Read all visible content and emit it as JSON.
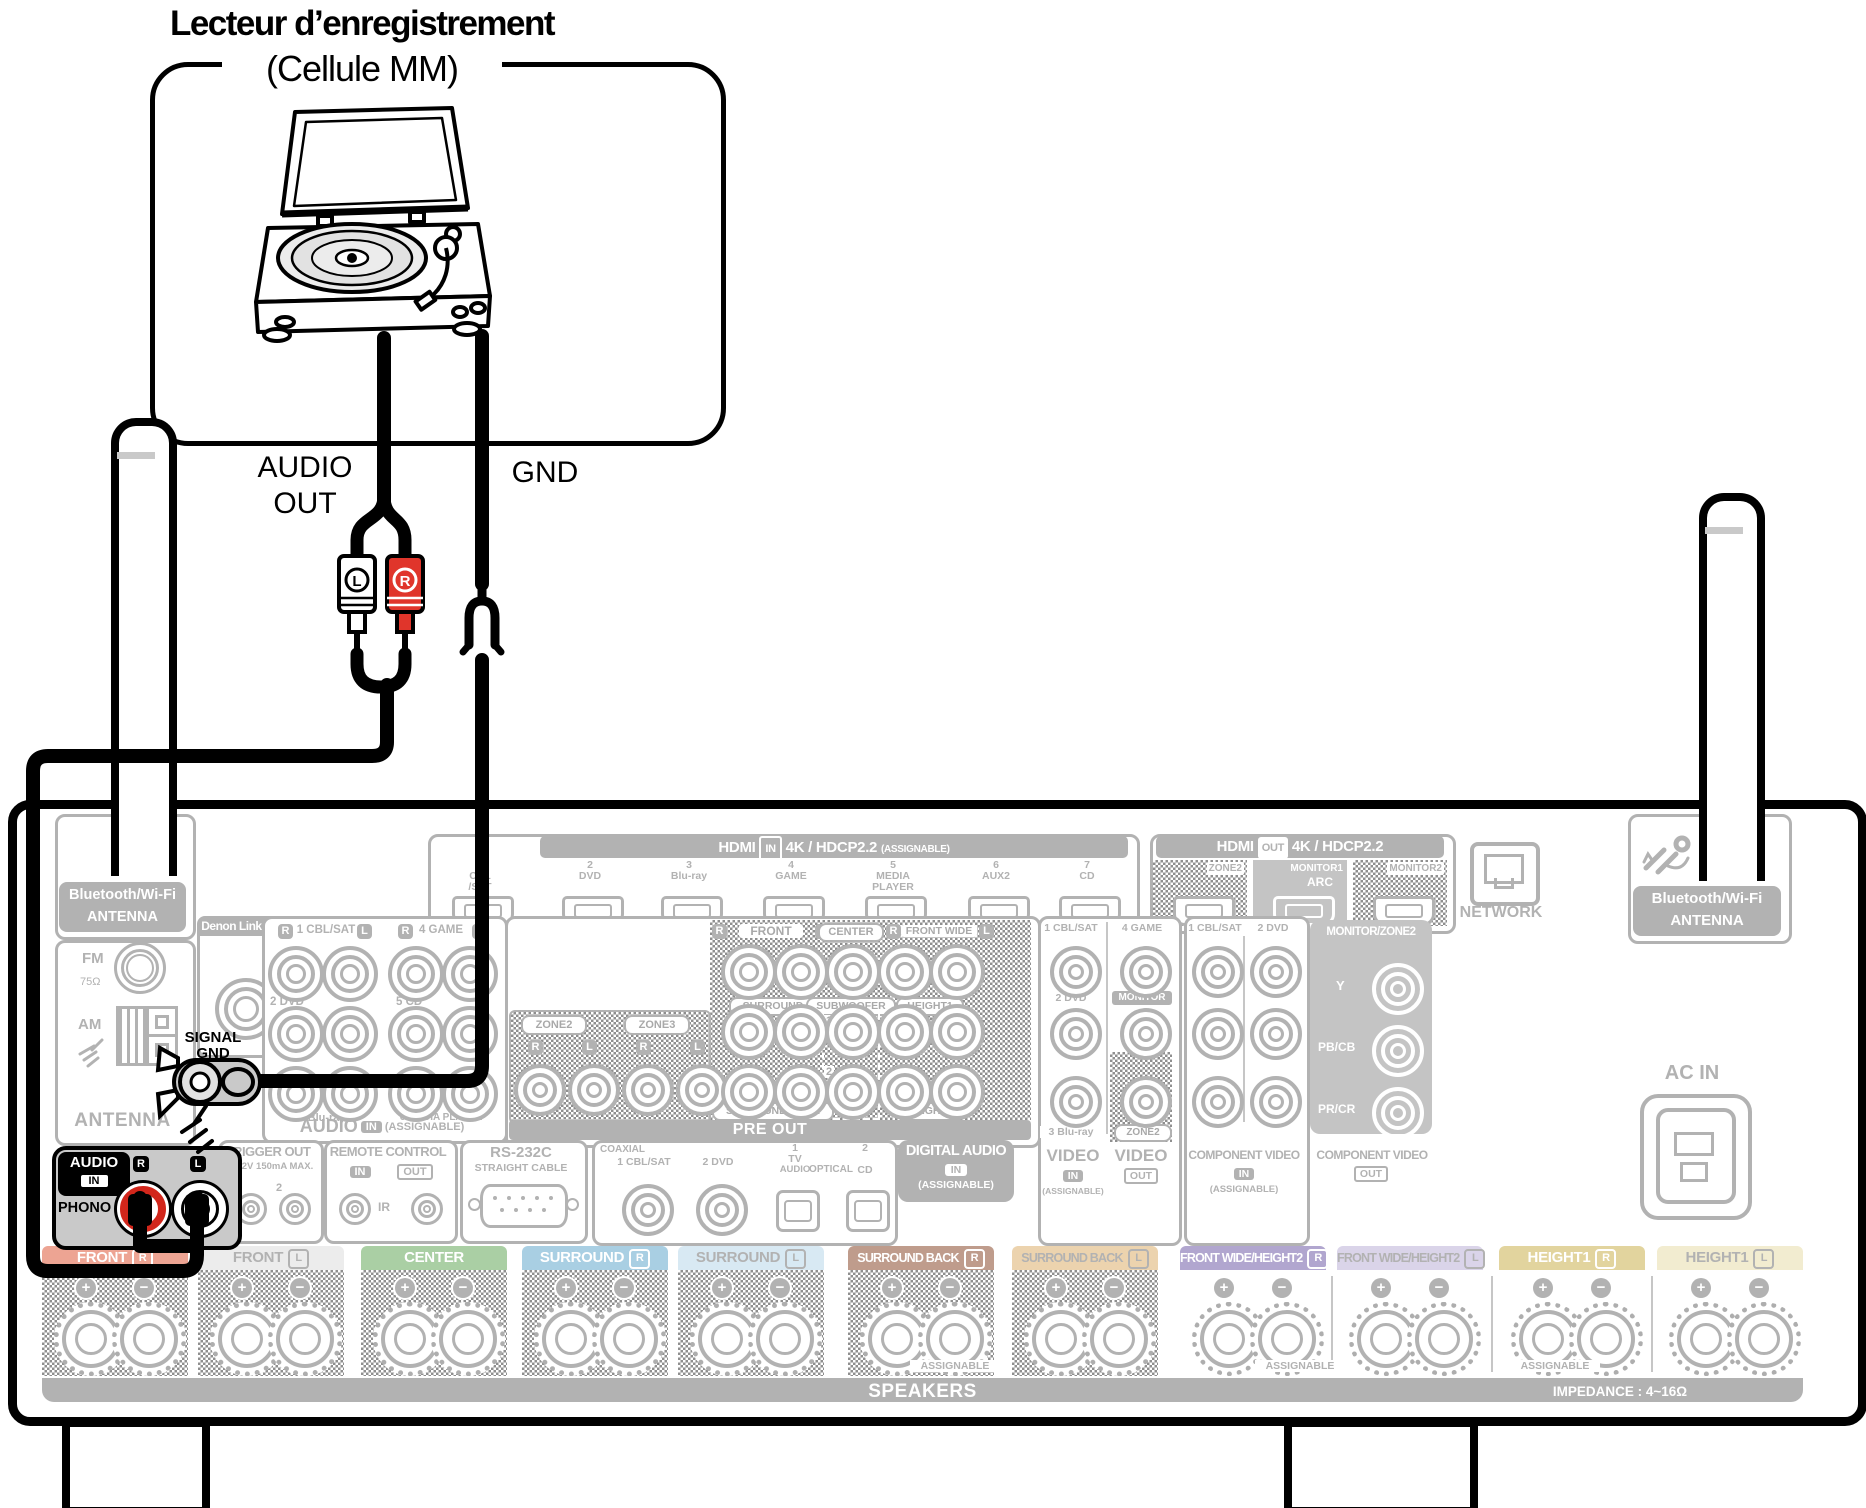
{
  "colors": {
    "gray_line": "#b2b2b2",
    "gray_fill": "#c4c4c4",
    "black": "#000000",
    "rca_red": "#d2261b",
    "front_r": "#eda493",
    "front_l": "#ececec",
    "center": "#aacfa4",
    "surround_r": "#a9cfe3",
    "surround_l": "#d8e9f3",
    "surround_back_r": "#bf9c8c",
    "surround_back_l": "#ecd3ae",
    "front_wide_r": "#b1a6cf",
    "front_wide_l": "#dad4e9",
    "height1_r": "#e2d49e",
    "height1_l": "#f2ecd0"
  },
  "source_device": {
    "title_line1": "Lecteur d’enregistrement",
    "title_line2": "(Cellule MM)"
  },
  "cable_labels": {
    "audio": "AUDIO",
    "out": "OUT",
    "gnd": "GND",
    "plug_l": "L",
    "plug_r": "R"
  },
  "receiver": {
    "hdmi_in": {
      "name": "HDMI",
      "badge": "IN",
      "spec": "4K / HDCP2.2",
      "assignable": "(ASSIGNABLE)",
      "ports": [
        [
          "1",
          "CBL",
          "/SAT"
        ],
        [
          "2",
          "DVD"
        ],
        [
          "3",
          "Blu-ray"
        ],
        [
          "4",
          "GAME"
        ],
        [
          "5",
          "MEDIA",
          "PLAYER"
        ],
        [
          "6",
          "AUX2"
        ],
        [
          "7",
          "CD"
        ]
      ]
    },
    "hdmi_out": {
      "name": "HDMI",
      "badge": "OUT",
      "spec": "4K / HDCP2.2",
      "ports": [
        {
          "label": "ZONE2",
          "sub": "",
          "hatched": true
        },
        {
          "label": "MONITOR1",
          "sub": "ARC",
          "hatched": false
        },
        {
          "label": "MONITOR2",
          "sub": "",
          "hatched": true
        }
      ]
    },
    "network": "NETWORK",
    "bt_antenna": {
      "line1": "Bluetooth/Wi-Fi",
      "line2": "ANTENNA"
    },
    "ac_in": "AC IN",
    "tuner": {
      "fm": "FM",
      "ohm": "75Ω",
      "am": "AM",
      "label": "ANTENNA"
    },
    "denon_link": "Denon Link HD",
    "audio_in": {
      "pair1": {
        "r": "R",
        "label": "1 CBL/SAT",
        "l": "L"
      },
      "pair2": {
        "r": "R",
        "label": "4 GAME",
        "l": "L"
      },
      "row2": [
        "2 DVD",
        "5 CD"
      ],
      "row3": [
        "3 Blu-ray",
        "6 MEDIA PLAYER"
      ],
      "footer": {
        "name": "AUDIO",
        "badge": "IN",
        "assignable": "(ASSIGNABLE)"
      }
    },
    "signal_gnd": {
      "line1": "SIGNAL",
      "line2": "GND"
    },
    "phono": {
      "name": "AUDIO",
      "badge": "IN",
      "input": "PHONO",
      "r": "R",
      "l": "L"
    },
    "trigger": {
      "title": "TRIGGER OUT",
      "sub": "DC12V 150mA MAX.",
      "n1": "1",
      "n2": "2"
    },
    "remote": {
      "title": "REMOTE CONTROL",
      "in": "IN",
      "out": "OUT",
      "ir": "IR"
    },
    "rs232": {
      "title": "RS-232C",
      "sub": "STRAIGHT CABLE"
    },
    "digital": {
      "coaxial": "COAXIAL",
      "c1": "1 CBL/SAT",
      "c2": "2 DVD",
      "o1": [
        "1",
        "TV",
        "AUDIO"
      ],
      "optical": "OPTICAL",
      "o2": [
        "2",
        "CD"
      ],
      "title": "DIGITAL AUDIO",
      "badge": "IN",
      "assignable": "(ASSIGNABLE)"
    },
    "pre_out": {
      "zone2": "ZONE2",
      "zone3": "ZONE3",
      "zone_badges": [
        "R",
        "L",
        "R",
        "L"
      ],
      "top": {
        "r1": "R",
        "front": "FRONT",
        "l1": "L",
        "center": "CENTER",
        "r2": "R",
        "front_wide": "FRONT WIDE",
        "l2": "L"
      },
      "mid": {
        "surround": "SURROUND",
        "subwoofer": "SUBWOOFER",
        "height1": "HEIGHT1",
        "n1": "1",
        "n2": "2"
      },
      "bottom": {
        "surround_back": "SURROUND BACK",
        "height2": "HEIGHT2"
      },
      "footer": "PRE OUT"
    },
    "video": {
      "in1": "1 CBL/SAT",
      "in2": "4 GAME",
      "in3": "2 DVD",
      "monitor": "MONITOR",
      "in4": "3 Blu-ray",
      "zone2": "ZONE2",
      "footer_in": {
        "name": "VIDEO",
        "badge": "IN",
        "assignable": "(ASSIGNABLE)"
      },
      "footer_out": {
        "name": "VIDEO",
        "badge": "OUT"
      }
    },
    "component_in": {
      "c1": "1 CBL/SAT",
      "c2": "2 DVD",
      "footer": {
        "name": "COMPONENT VIDEO",
        "badge": "IN",
        "assignable": "(ASSIGNABLE)"
      }
    },
    "component_out": {
      "header": "MONITOR/ZONE2",
      "y": "Y",
      "pb": "PB/CB",
      "pr": "PR/CR",
      "footer": {
        "name": "COMPONENT VIDEO",
        "badge": "OUT"
      }
    },
    "speakers": {
      "blocks": [
        {
          "label": "FRONT",
          "rl": "R",
          "bg": "#eda493",
          "fg": "#ffffff",
          "hatch": true
        },
        {
          "label": "FRONT",
          "rl": "L",
          "bg": "#ececec",
          "fg": "#b2b2b2",
          "hatch": true
        },
        {
          "label": "CENTER",
          "rl": "",
          "bg": "#aacfa4",
          "fg": "#ffffff",
          "hatch": true
        },
        {
          "label": "SURROUND",
          "rl": "R",
          "bg": "#a9cfe3",
          "fg": "#ffffff",
          "hatch": true
        },
        {
          "label": "SURROUND",
          "rl": "L",
          "bg": "#d8e9f3",
          "fg": "#b2b2b2",
          "hatch": true
        },
        {
          "label": "SURROUND BACK",
          "rl": "R",
          "bg": "#bf9c8c",
          "fg": "#ffffff",
          "hatch": true
        },
        {
          "label": "SURROUND BACK",
          "rl": "L",
          "bg": "#ecd3ae",
          "fg": "#b2b2b2",
          "hatch": true
        },
        {
          "label": "FRONT WIDE/HEIGHT2",
          "rl": "R",
          "bg": "#b1a6cf",
          "fg": "#ffffff",
          "hatch": false
        },
        {
          "label": "FRONT WIDE/HEIGHT2",
          "rl": "L",
          "bg": "#dad4e9",
          "fg": "#b2b2b2",
          "hatch": false
        },
        {
          "label": "HEIGHT1",
          "rl": "R",
          "bg": "#e2d49e",
          "fg": "#ffffff",
          "hatch": false
        },
        {
          "label": "HEIGHT1",
          "rl": "L",
          "bg": "#f2ecd0",
          "fg": "#b2b2b2",
          "hatch": false
        }
      ],
      "assignable": "ASSIGNABLE",
      "bar": "SPEAKERS",
      "impedance": "IMPEDANCE : 4~16Ω",
      "plus": "+",
      "minus": "−"
    }
  }
}
